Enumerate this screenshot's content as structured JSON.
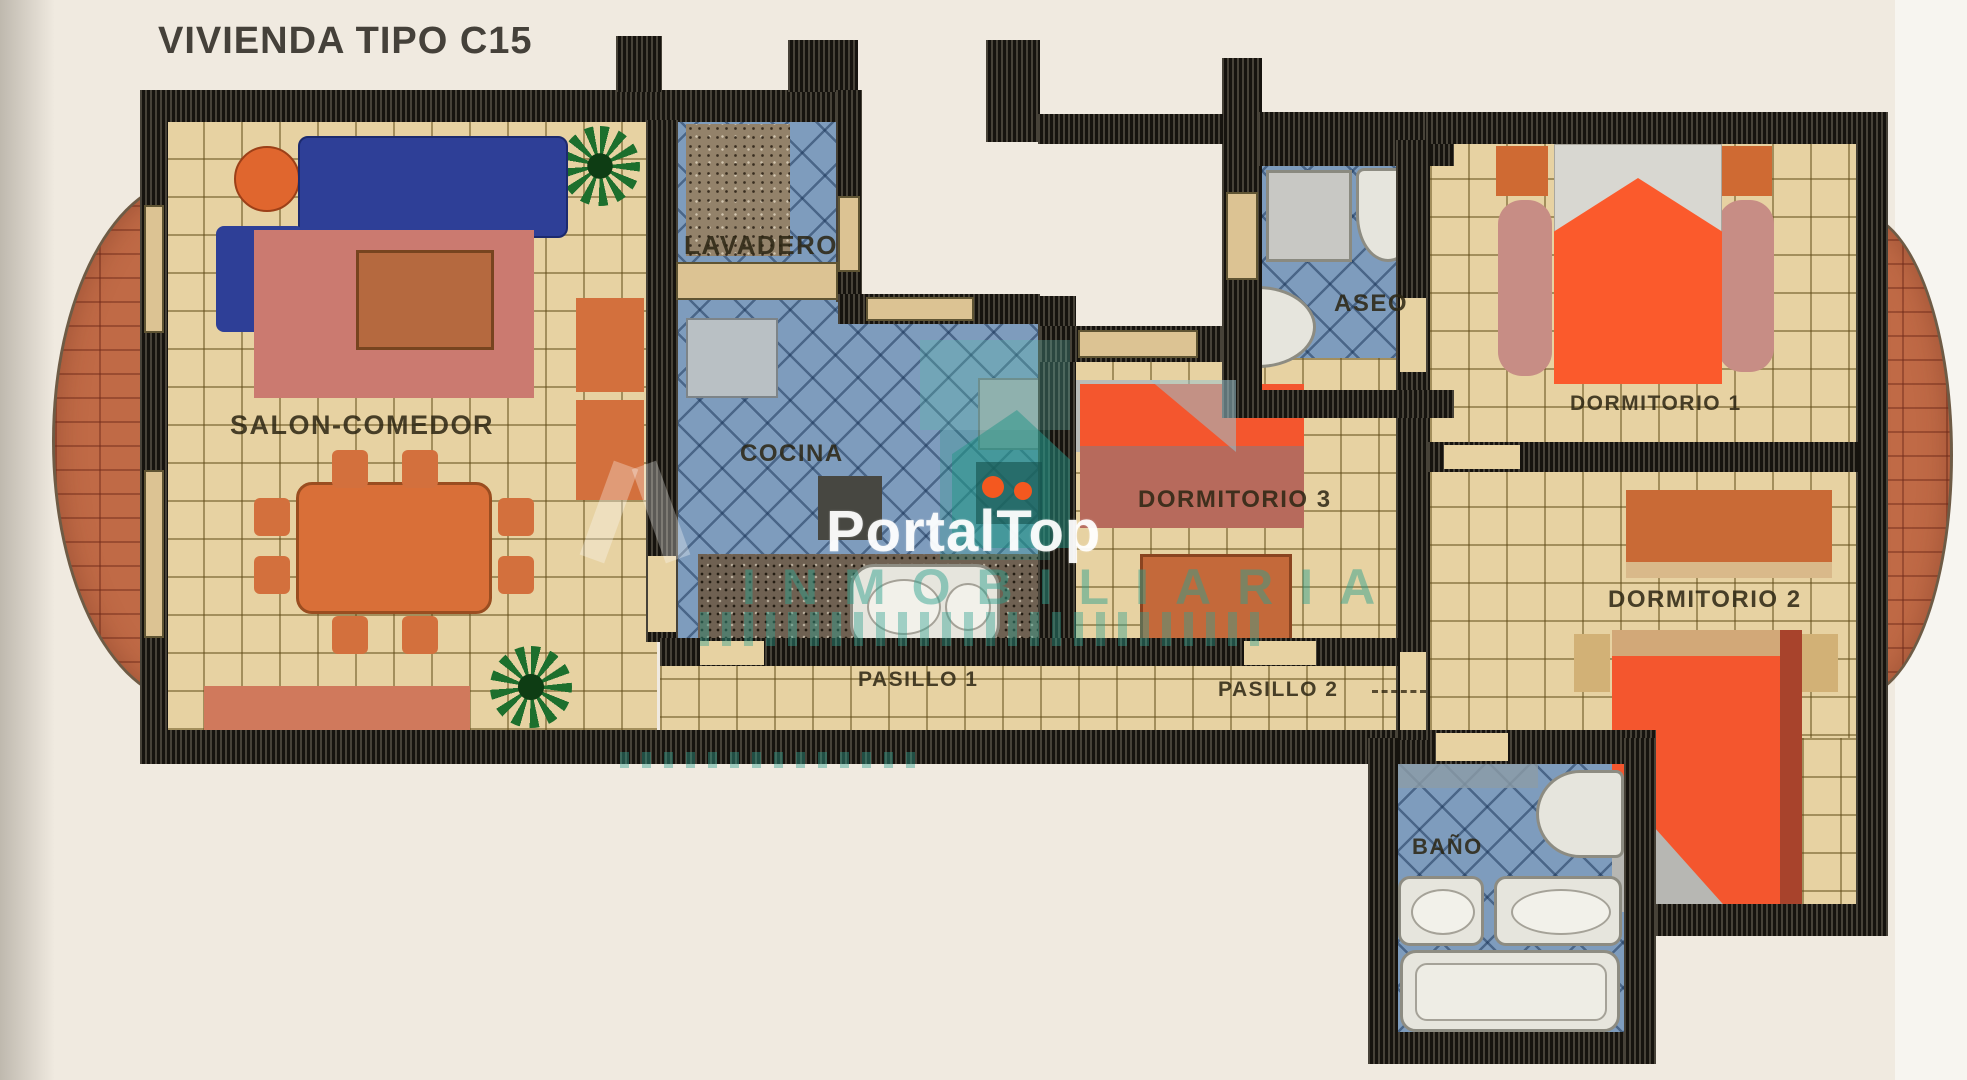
{
  "title": "VIVIENDA TIPO C15",
  "rooms": {
    "salon": "SALON-COMEDOR",
    "lavadero": "LAVADERO",
    "cocina": "COCINA",
    "aseo": "ASEO",
    "dormitorio1": "DORMITORIO 1",
    "dormitorio3": "DORMITORIO 3",
    "dormitorio2": "DORMITORIO 2",
    "pasillo1": "PASILLO 1",
    "pasillo2": "PASILLO 2",
    "bano": "BAÑO"
  },
  "watermark": {
    "brand": "PortalTop",
    "tagline": "INMOBILIARIA"
  },
  "colors": {
    "paper": "#f0eae0",
    "tan_floor": "#e7d2a2",
    "blue_floor": "#7e9cbd",
    "terracotta_balcony": "#c06a46",
    "wall_dark": "#16130e",
    "furniture_orange": "#d3703d",
    "bed_orange": "#fa5a2c",
    "sofa_blue": "#2e3f97",
    "rug_pink": "#cb7a70",
    "granite_counter": "#6f6152",
    "plant_green": "#1d6f2d",
    "watermark_teal": "#2fa08f",
    "watermark_white": "#ffffff"
  }
}
